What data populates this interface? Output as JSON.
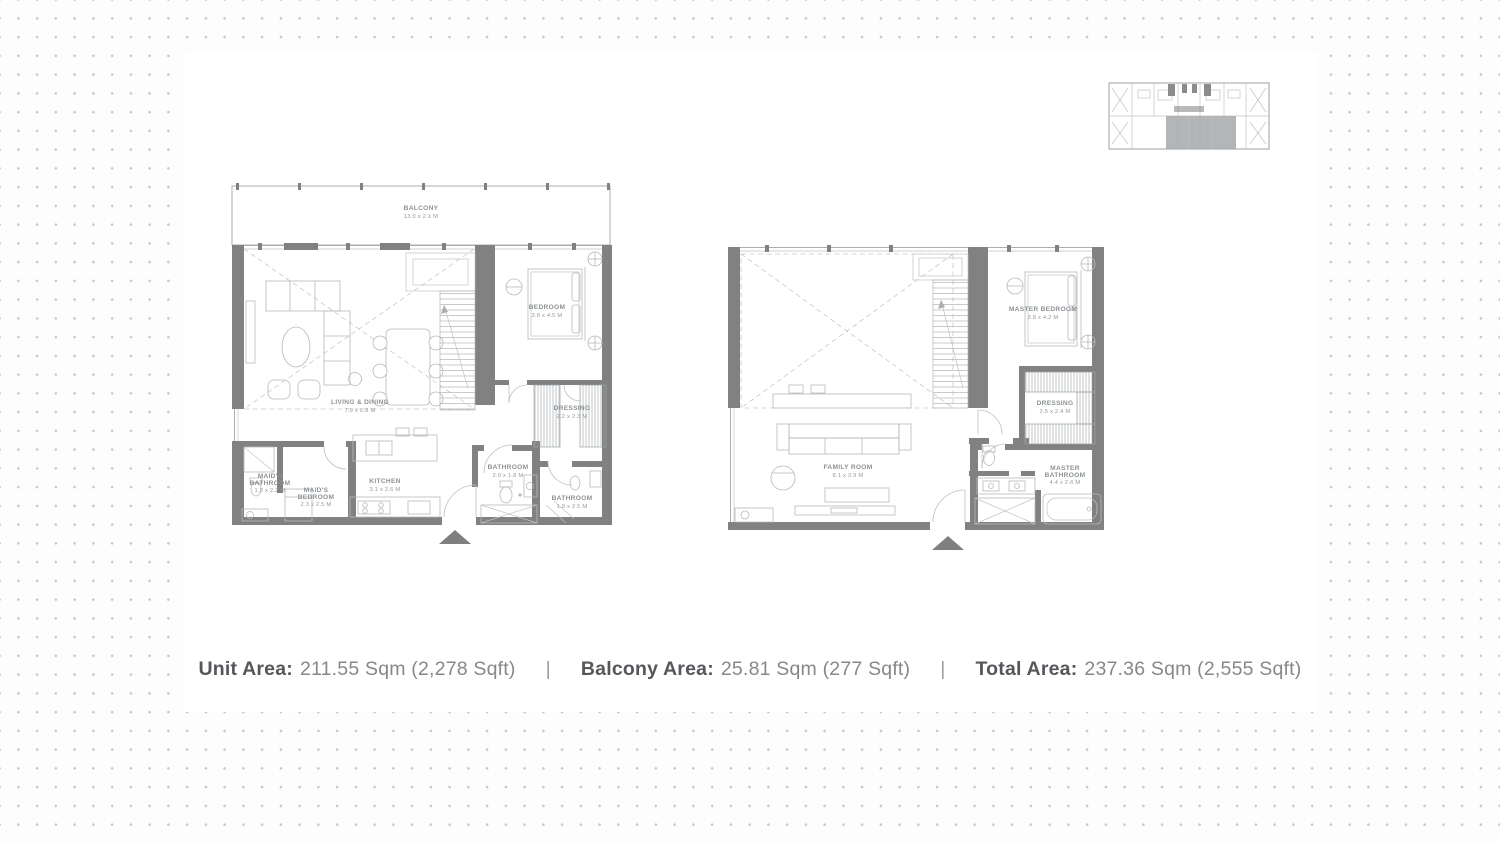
{
  "plans": {
    "lower": {
      "rooms": {
        "balcony": {
          "name": "BALCONY",
          "dims": "13.0 x 2.1 M"
        },
        "living_dining": {
          "name": "LIVING & DINING",
          "dims": "7.9 x 6.9 M"
        },
        "bedroom": {
          "name": "BEDROOM",
          "dims": "3.8 x 4.5 M"
        },
        "dressing": {
          "name": "DRESSING",
          "dims": "2.2 x 2.3 M"
        },
        "bathroom": {
          "name": "BATHROOM",
          "dims": "2.0 x 1.8 M"
        },
        "bathroom2": {
          "name": "BATHROOM",
          "dims": "1.9 x 2.5 M"
        },
        "kitchen": {
          "name": "KITCHEN",
          "dims": "3.1 x 2.6 M"
        },
        "maids_bedroom": {
          "name1": "MAID'S",
          "name2": "BEDROOM",
          "dims": "2.3 x 2.5 M"
        },
        "maids_bathroom": {
          "name1": "MAID'S",
          "name2": "BATHROOM",
          "dims": "1.2 x 2.2 M"
        }
      }
    },
    "upper": {
      "rooms": {
        "master_bedroom": {
          "name": "MASTER BEDROOM",
          "dims": "3.8 x 4.2 M"
        },
        "dressing": {
          "name": "DRESSING",
          "dims": "2.5 x 2.4 M"
        },
        "master_bathroom": {
          "name1": "MASTER",
          "name2": "BATHROOM",
          "dims": "4.4 x 2.6 M"
        },
        "family_room": {
          "name": "FAMILY ROOM",
          "dims": "8.1 x 3.9 M"
        }
      }
    }
  },
  "footer": {
    "separator": "|",
    "items": [
      {
        "label": "Unit Area:",
        "value": "211.55 Sqm (2,278 Sqft)"
      },
      {
        "label": "Balcony Area:",
        "value": "25.81 Sqm (277 Sqft)"
      },
      {
        "label": "Total Area:",
        "value": "237.36 Sqm (2,555 Sqft)"
      }
    ]
  },
  "colors": {
    "wall": "#818181",
    "label_bold": "#55575a",
    "label_value": "#85888b",
    "dots": "#c6c6c8"
  }
}
